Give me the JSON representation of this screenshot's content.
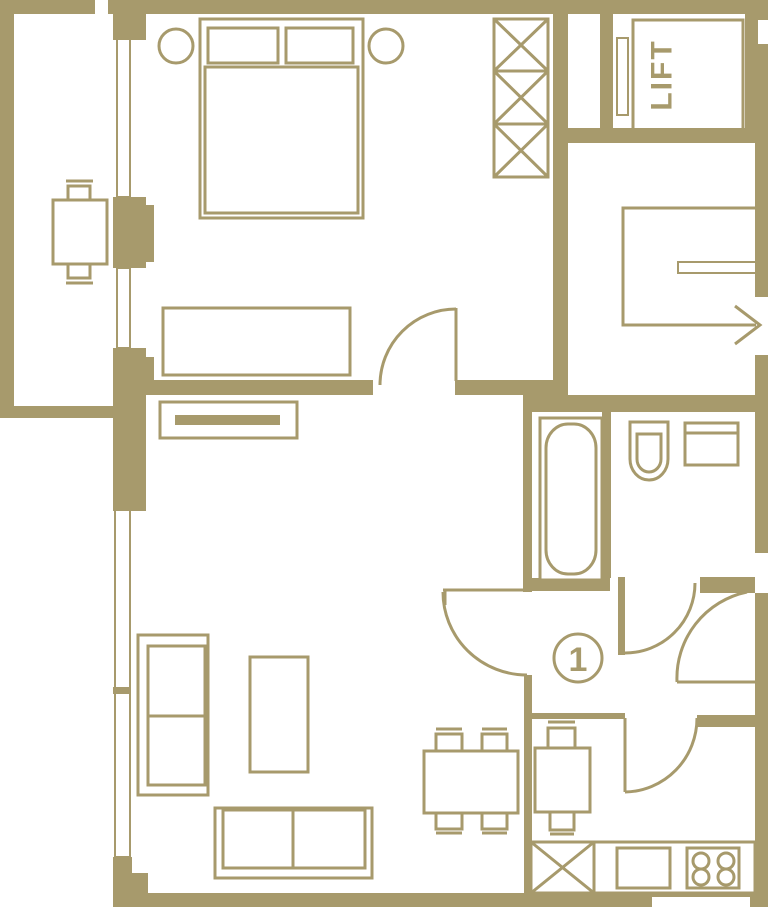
{
  "colors": {
    "accent": "#a79a6c",
    "background": "#ffffff"
  },
  "labels": {
    "lift": "LIFT",
    "unit_number": "1"
  }
}
